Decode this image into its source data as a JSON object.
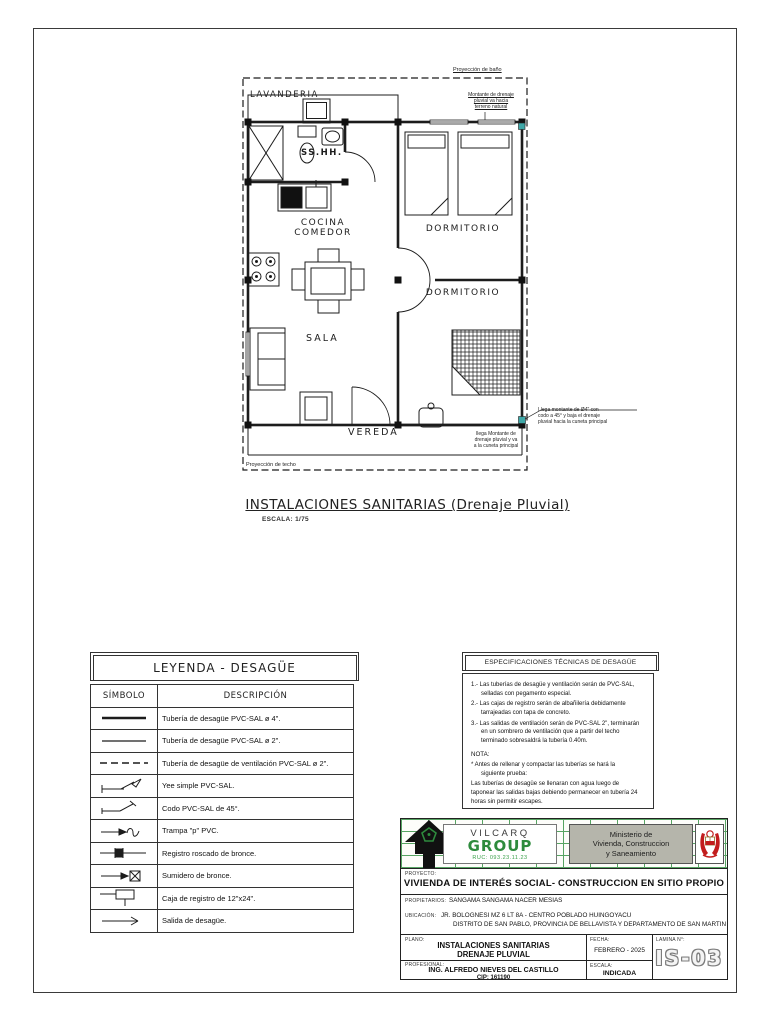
{
  "plan": {
    "title": "INSTALACIONES SANITARIAS (Drenaje Pluvial)",
    "scale": "ESCALA: 1/75",
    "rooms": {
      "lavanderia": "LAVANDERIA",
      "sshh": "SS.HH.",
      "cocina": "COCINA\nCOMEDOR",
      "dormitorio_1": "DORMITORIO",
      "dormitorio_2": "DORMITORIO",
      "sala": "SALA",
      "vereda": "VEREDA"
    },
    "annotations": {
      "proyeccion_bano": "Proyección de baño",
      "proyeccion_techo": "Proyección de techo",
      "montante_sube": "Montante de drenaje\npluvial va hacia\nterreno natural",
      "montante_detalle": "Llega montante de Ø4\" con\ncodo a 45° y baja el drenaje\npluvial hacia la cuneta principal",
      "montante_llega": "llega Montante de\ndrenaje pluvial y va\na la cuneta principal"
    }
  },
  "legend": {
    "title": "LEYENDA - DESAGÜE",
    "col_symbol": "SÍMBOLO",
    "col_description": "DESCRIPCIÓN",
    "rows": [
      {
        "symbol": "pipe-4",
        "description": "Tubería de desagüe PVC-SAL ø 4\"."
      },
      {
        "symbol": "pipe-2",
        "description": "Tubería de desagüe PVC-SAL ø 2\"."
      },
      {
        "symbol": "pipe-vent",
        "description": "Tubería de desagüe de ventilación PVC-SAL ø 2\"."
      },
      {
        "symbol": "yee",
        "description": "Yee simple PVC-SAL."
      },
      {
        "symbol": "codo-45",
        "description": "Codo PVC-SAL de 45°."
      },
      {
        "symbol": "trampa-p",
        "description": "Trampa \"p\" PVC."
      },
      {
        "symbol": "registro-roscado",
        "description": "Registro roscado de bronce."
      },
      {
        "symbol": "sumidero",
        "description": "Sumidero de bronce."
      },
      {
        "symbol": "caja-registro",
        "description": "Caja de registro de 12\"x24\"."
      },
      {
        "symbol": "salida",
        "description": "Salida de desagüe."
      }
    ]
  },
  "specs": {
    "title": "ESPECIFICACIONES TÉCNICAS DE DESAGÜE",
    "items": [
      "1.- Las tuberías de desagüe y ventilación serán de PVC-SAL,\nselladas con pegamento especial.",
      "2.- Las cajas de registro serán de albañilería debidamente\ntarrajeadas con tapa de concreto.",
      "3.- Las salidas de ventilación serán de PVC-SAL 2\", terminarán\nen un sombrero de ventilación que a partir del techo\nterminado sobresaldrá la tubería 0.40m."
    ],
    "nota_label": "NOTA:",
    "nota_line1": "* Antes de rellenar y compactar las tuberías se hará la\nsiguiente prueba:",
    "nota_line2": "Las tuberías de desagüe se llenaran con agua luego de\ntaponear las salidas bajas debiendo permanecer en tubería 24\nhoras sin permitir escapes."
  },
  "titleblock": {
    "brand": {
      "name_top": "VILCARQ",
      "name_main": "GROUP",
      "contact": "RUC: 093.23.11.23"
    },
    "ministry": "Ministerio de\nVivienda, Construccion\ny Saneamiento",
    "labels": {
      "proyecto": "PROYECTO:",
      "propietarios": "PROPIETARIOS:",
      "ubicacion": "UBICACIÓN:",
      "plano": "PLANO:",
      "profesional": "PROFESIONAL:",
      "fecha": "FECHA:",
      "escala": "ESCALA:",
      "lamina": "LAMINA N°:"
    },
    "proyecto": "VIVIENDA DE INTERÉS SOCIAL- CONSTRUCCION EN SITIO PROPIO",
    "propietarios": "SANGAMA SANGAMA NACER MESIAS",
    "ubicacion_1": "JR. BOLOGNESI MZ 6 LT 8A - CENTRO POBLADO HUINGOYACU",
    "ubicacion_2": "DISTRITO DE SAN PABLO, PROVINCIA DE BELLAVISTA Y DEPARTAMENTO DE SAN MARTIN",
    "plano": "INSTALACIONES SANITARIAS\nDRENAJE PLUVIAL",
    "profesional": "ING. ALFREDO NIEVES DEL CASTILLO",
    "cip": "CIP: 161190",
    "fecha": "FEBRERO - 2025",
    "escala": "INDICADA",
    "lamina": "IS-03"
  },
  "colors": {
    "accent_green": "#2e8b3d",
    "brick_line": "#57a463",
    "ministry_bg": "#b5b5ab",
    "marker_teal": "#3fa8a8"
  }
}
